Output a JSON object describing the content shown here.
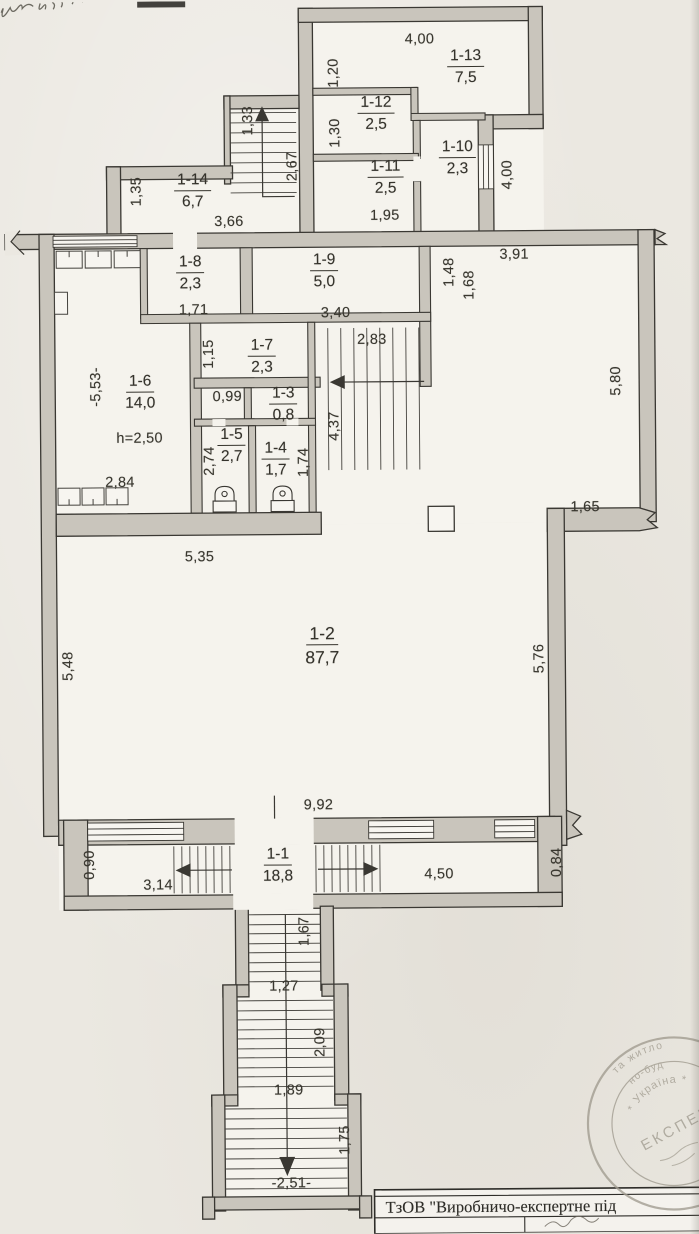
{
  "colors": {
    "paper": "#ebe8e1",
    "room_fill": "#f5f3ed",
    "wall_fill": "#c9c5bc",
    "ink": "#3a3833",
    "stamp": "#a29d91"
  },
  "rooms": [
    {
      "id": "1-13",
      "area": "7,5",
      "x": 470,
      "y": 61
    },
    {
      "id": "1-12",
      "area": "2,5",
      "x": 380,
      "y": 107
    },
    {
      "id": "1-11",
      "area": "2,5",
      "x": 389,
      "y": 171
    },
    {
      "id": "1-10",
      "area": "2,3",
      "x": 461,
      "y": 152
    },
    {
      "id": "1-14",
      "area": "6,7",
      "x": 196,
      "y": 183
    },
    {
      "id": "1-8",
      "area": "2,3",
      "x": 193,
      "y": 265
    },
    {
      "id": "1-9",
      "area": "5,0",
      "x": 327,
      "y": 264
    },
    {
      "id": "1-7",
      "area": "2,3",
      "x": 264,
      "y": 349
    },
    {
      "id": "1-6",
      "area": "14,0",
      "x": 142,
      "y": 384
    },
    {
      "id": "1-3",
      "area": "0,8",
      "x": 285,
      "y": 397
    },
    {
      "id": "1-5",
      "area": "2,7",
      "x": 233,
      "y": 438
    },
    {
      "id": "1-4",
      "area": "1,7",
      "x": 277,
      "y": 452
    },
    {
      "id": "1-2",
      "area": "87,7",
      "x": 322,
      "y": 636,
      "big": true
    },
    {
      "id": "1-1",
      "area": "18,8",
      "x": 276,
      "y": 858
    }
  ],
  "dims": [
    {
      "t": "4,00",
      "x": 424,
      "y": 40
    },
    {
      "t": "1,95",
      "x": 388,
      "y": 216
    },
    {
      "t": "3,66",
      "x": 232,
      "y": 221
    },
    {
      "t": "3,91",
      "x": 517,
      "y": 256
    },
    {
      "t": "1,71",
      "x": 196,
      "y": 309
    },
    {
      "t": "3,40",
      "x": 338,
      "y": 313
    },
    {
      "t": "2,83",
      "x": 374,
      "y": 340
    },
    {
      "t": "0,99",
      "x": 229,
      "y": 396
    },
    {
      "t": "h=2,50",
      "x": 141,
      "y": 437
    },
    {
      "t": "2,84",
      "x": 121,
      "y": 481
    },
    {
      "t": "1,65",
      "x": 586,
      "y": 509
    },
    {
      "t": "5,35",
      "x": 200,
      "y": 556
    },
    {
      "t": "9,92",
      "x": 317,
      "y": 805
    },
    {
      "t": "3,14",
      "x": 156,
      "y": 884
    },
    {
      "t": "4,50",
      "x": 437,
      "y": 875
    },
    {
      "t": "1,27",
      "x": 281,
      "y": 986
    },
    {
      "t": "1,89",
      "x": 285,
      "y": 1090
    },
    {
      "t": "-2,51-",
      "x": 287,
      "y": 1183
    },
    {
      "t": "1,20",
      "x": 338,
      "y": 73,
      "v": true
    },
    {
      "t": "1,30",
      "x": 339,
      "y": 133,
      "v": true
    },
    {
      "t": "4,00",
      "x": 511,
      "y": 176,
      "v": true
    },
    {
      "t": "1,33",
      "x": 252,
      "y": 120,
      "v": true
    },
    {
      "t": "2,67",
      "x": 296,
      "y": 166,
      "v": true
    },
    {
      "t": "1,35",
      "x": 140,
      "y": 190,
      "v": true
    },
    {
      "t": "1,48",
      "x": 452,
      "y": 273,
      "v": true
    },
    {
      "t": "1,68",
      "x": 472,
      "y": 286,
      "v": true
    },
    {
      "t": "1,15",
      "x": 211,
      "y": 353,
      "v": true
    },
    {
      "t": "-5,53-",
      "x": 98,
      "y": 385,
      "v": true
    },
    {
      "t": "4,37",
      "x": 336,
      "y": 426,
      "v": true
    },
    {
      "t": "2,74",
      "x": 211,
      "y": 460,
      "v": true
    },
    {
      "t": "1,74",
      "x": 305,
      "y": 462,
      "v": true
    },
    {
      "t": "5,80",
      "x": 618,
      "y": 383,
      "v": true
    },
    {
      "t": "5,48",
      "x": 68,
      "y": 664,
      "v": true
    },
    {
      "t": "5,76",
      "x": 539,
      "y": 660,
      "v": true
    },
    {
      "t": "0,90",
      "x": 88,
      "y": 863,
      "v": true
    },
    {
      "t": "0,84",
      "x": 555,
      "y": 864,
      "v": true
    },
    {
      "t": "1,67",
      "x": 302,
      "y": 931,
      "v": true
    },
    {
      "t": "2,09",
      "x": 317,
      "y": 1042,
      "v": true
    },
    {
      "t": "1,75",
      "x": 341,
      "y": 1140,
      "v": true
    }
  ],
  "title_block": {
    "company": "ТзОВ \"Виробничо-експертне під"
  },
  "stamp": {
    "arc_outer": "та житло",
    "arc_mid": "но-буд",
    "arc_inner": "* Україна *",
    "center": "ЕКСПЕР"
  }
}
